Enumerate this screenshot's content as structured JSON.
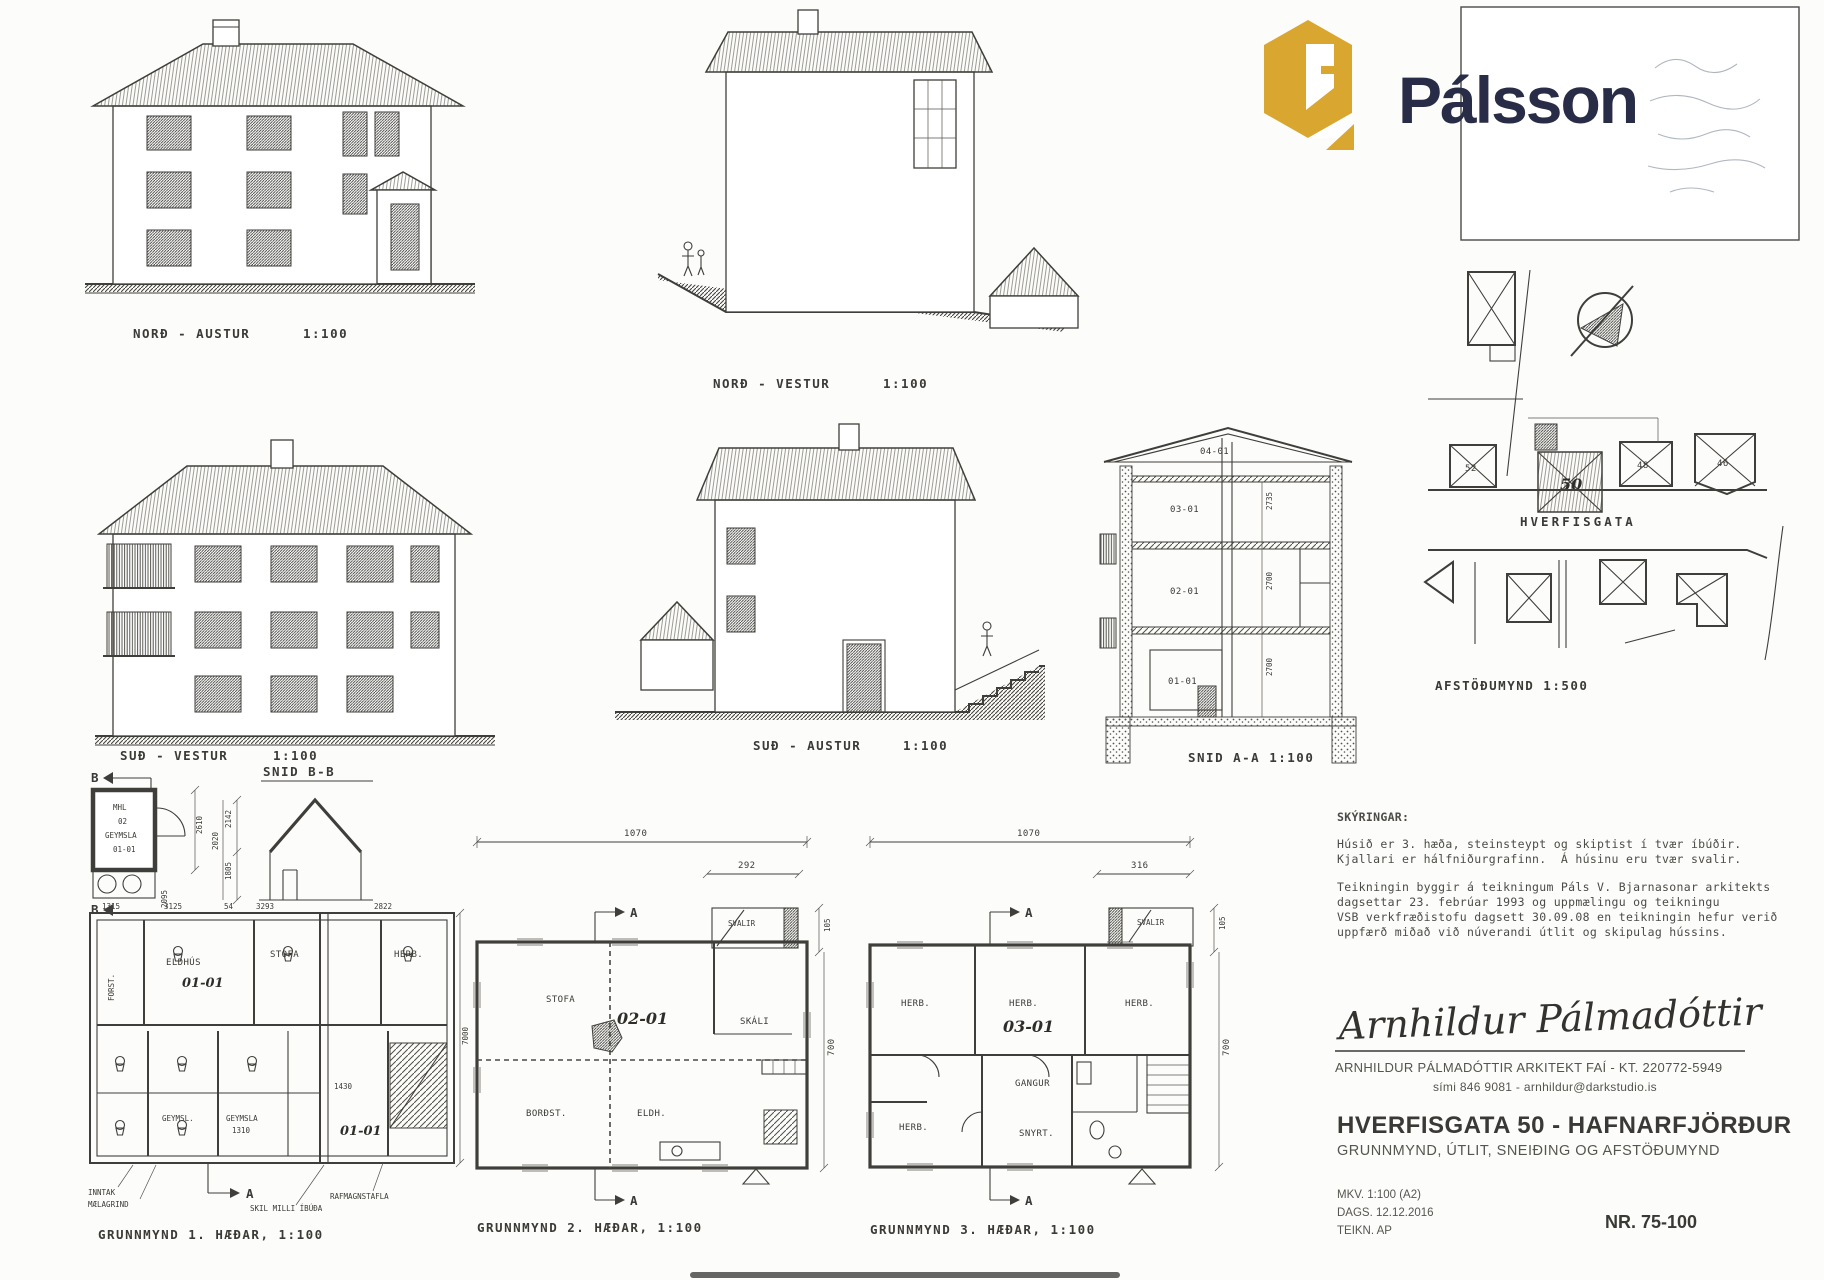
{
  "brand": {
    "wordmark": "Pálsson",
    "gold": "#D9A62F",
    "navy": "#282C47"
  },
  "elevations": {
    "ne": {
      "label": "NORÐ - AUSTUR",
      "scale": "1:100"
    },
    "nw": {
      "label": "NORÐ - VESTUR",
      "scale": "1:100"
    },
    "sw": {
      "label": "SUÐ - VESTUR",
      "scale": "1:100"
    },
    "se": {
      "label": "SUÐ - AUSTUR",
      "scale": "1:100"
    }
  },
  "section_aa": {
    "label": "SNID A-A 1:100",
    "units": [
      "04-01",
      "03-01",
      "02-01",
      "01-01"
    ],
    "dims": [
      "2735",
      "2700",
      "2700"
    ]
  },
  "snid_bb": {
    "label": "SNID B-B",
    "dims": [
      "2142",
      "2020",
      "1805"
    ]
  },
  "storage": {
    "marker": "B",
    "mhl": "MHL",
    "num": "02",
    "name": "GEYMSLA",
    "unit": "01-01",
    "dim_h": "2610",
    "dim_w": "2095"
  },
  "siteplan": {
    "street": "HVERFISGATA",
    "label": "AFSTÖÐUMYND 1:500",
    "lots": {
      "l52": "52",
      "l50": "50",
      "l48": "48",
      "l46": "46"
    }
  },
  "plan1": {
    "label": "GRUNNMYND 1. HÆÐAR, 1:100",
    "marker": "A",
    "rooms": {
      "forst": "FORST.",
      "eldhus": "ELDHÚS",
      "stofa": "STOFA",
      "herb": "HERB.",
      "geymsl": "GEYMSL.",
      "geymsla": "GEYMSLA",
      "unit": "01-01"
    },
    "dims": {
      "d1": "1315",
      "d2": "3125",
      "d3": "54",
      "d4": "3293",
      "d5": "2822",
      "d6": "7000",
      "d7": "1430",
      "d8": "1310"
    },
    "callouts": {
      "inntak": "INNTAK",
      "maelagrind": "MÆLAGRIND",
      "skil": "SKIL MILLI ÍBÚÐA",
      "tafla": "RAFMAGNSTAFLA"
    }
  },
  "plan2": {
    "label": "GRUNNMYND 2. HÆÐAR, 1:100",
    "marker": "A",
    "unit": "02-01",
    "rooms": {
      "stofa": "STOFA",
      "skali": "SKÁLI",
      "svalir": "SVALIR",
      "bordst": "BORÐST.",
      "eldh": "ELDH."
    },
    "dims": {
      "top": "1070",
      "sub": "292",
      "side_small": "105",
      "side": "700"
    }
  },
  "plan3": {
    "label": "GRUNNMYND 3. HÆÐAR, 1:100",
    "marker": "A",
    "unit": "03-01",
    "rooms": {
      "herb1": "HERB.",
      "herb2": "HERB.",
      "herb3": "HERB.",
      "gangur": "GANGUR",
      "herb4": "HERB.",
      "snyrt": "SNYRT.",
      "svalir": "SVALIR"
    },
    "dims": {
      "top": "1070",
      "sub": "316",
      "side_small": "105",
      "side": "700"
    }
  },
  "notes": {
    "heading": "SKÝRINGAR:",
    "p1l1": "Húsið er 3. hæða, steinsteypt og skiptist í tvær íbúðir.",
    "p1l2": "Kjallari er hálfniðurgrafinn.  Á húsinu eru tvær svalir.",
    "p2l1": "Teikningin byggir á teikningum Páls V. Bjarnasonar arkitekts",
    "p2l2": "dagsettar 23. febrúar 1993 og uppmælingu og teikningu",
    "p2l3": "VSB verkfræðistofu dagsett 30.09.08 en teikningin hefur verið",
    "p2l4": "uppfærð miðað við núverandi útlit og skipulag hússins."
  },
  "architect": {
    "signature": "Arnhildur Pálmadóttir",
    "name": "ARNHILDUR PÁLMADÓTTIR ARKITEKT FAÍ - KT. 220772-5949",
    "contact": "sími 846 9081 - arnhildur@darkstudio.is"
  },
  "titleblock": {
    "title": "HVERFISGATA 50 - HAFNARFJÖRÐUR",
    "subtitle": "GRUNNMYND, ÚTLIT, SNEIÐING OG AFSTÖÐUMYND",
    "mkv": "MKV. 1:100 (A2)",
    "dags": "DAGS. 12.12.2016",
    "teikn": "TEIKN. AP",
    "nr": "NR. 75-100"
  }
}
